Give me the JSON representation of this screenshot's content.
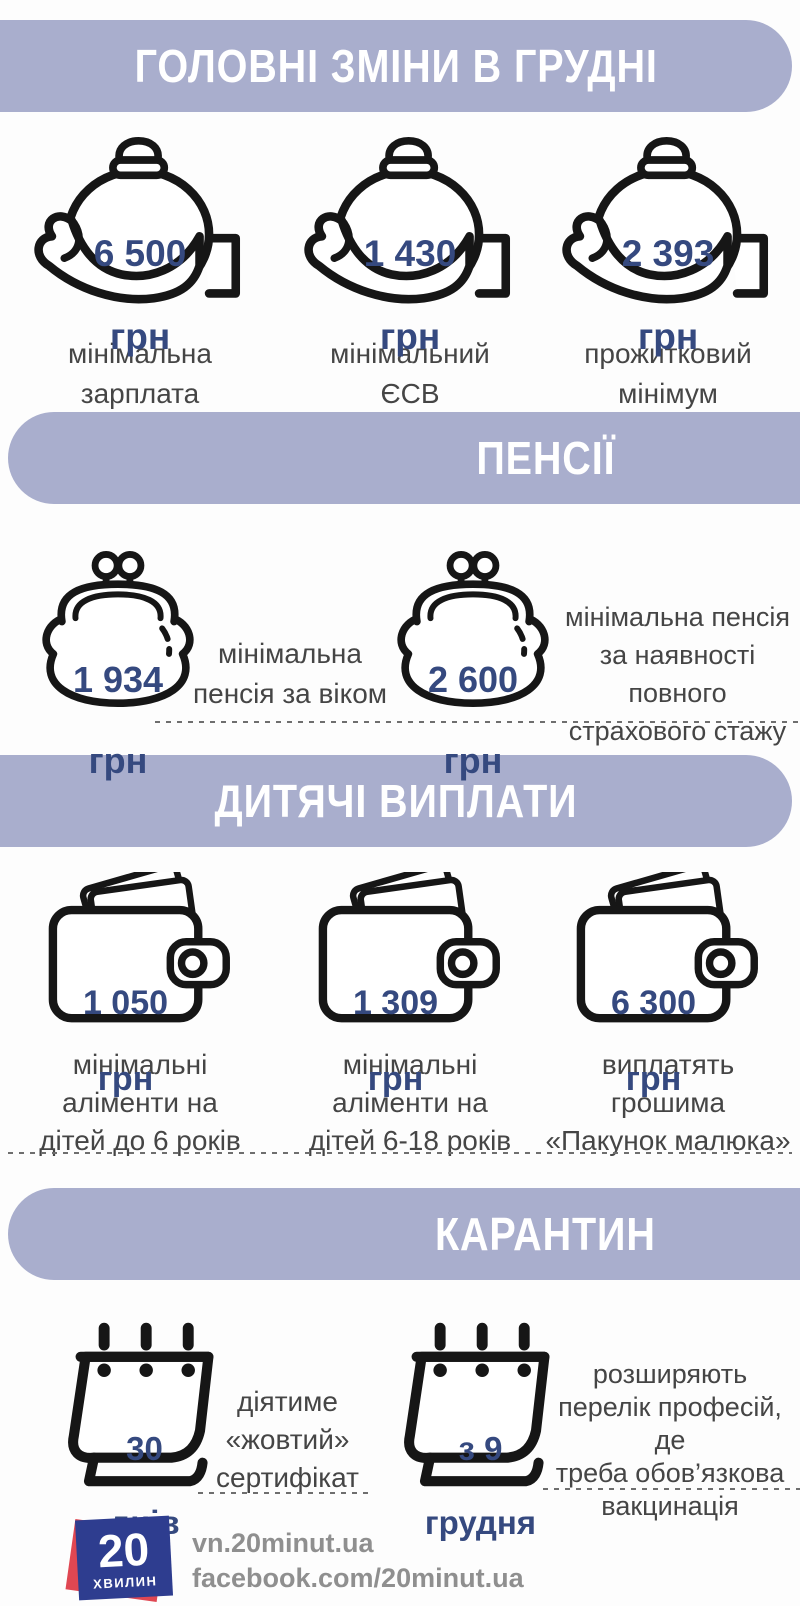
{
  "colors": {
    "banner_lavender": "#a9aecd",
    "value_blue": "#35497f",
    "label_gray": "#454545",
    "icon_black": "#161616",
    "footer_gray": "#8f8f8f",
    "logo_blue": "#2e3d8f",
    "logo_red": "#e04752"
  },
  "banners": {
    "main": "ГОЛОВНІ ЗМІНИ В ГРУДНІ",
    "pensions": "ПЕНСІЇ",
    "child": "ДИТЯЧІ ВИПЛАТИ",
    "quarantine": "КАРАНТИН"
  },
  "money_row": {
    "items": [
      {
        "value": "6 500",
        "unit": "грн",
        "label": "мінімальна\nзарплата"
      },
      {
        "value": "1 430",
        "unit": "грн",
        "label": "мінімальний\nЄСВ"
      },
      {
        "value": "2 393",
        "unit": "грн",
        "label": "прожитковий\nмінімум"
      }
    ]
  },
  "pensions_row": {
    "items": [
      {
        "value": "1 934",
        "unit": "грн",
        "label": "мінімальна\nпенсія за віком"
      },
      {
        "value": "2 600",
        "unit": "грн",
        "label": "мінімальна пенсія\nза наявності повного\nстрахового стажу"
      }
    ]
  },
  "child_row": {
    "items": [
      {
        "value": "1 050",
        "unit": "грн",
        "label": "мінімальні\nаліменти на\nдітей до 6 років"
      },
      {
        "value": "1 309",
        "unit": "грн",
        "label": "мінімальні\nаліменти на\nдітей 6-18 років"
      },
      {
        "value": "6 300",
        "unit": "грн",
        "label": "виплатять\nгрошима\n«Пакунок малюка»"
      }
    ]
  },
  "quarantine_row": {
    "items": [
      {
        "value": "30",
        "unit": "днів",
        "label": "діятиме\n«жовтий»\nсертифікат"
      },
      {
        "value": "з 9",
        "unit": "грудня",
        "label": "розширяють\nперелік професій, де\nтреба обов’язкова\nвакцинація"
      }
    ]
  },
  "footer": {
    "logo_number": "20",
    "logo_word": "ХВИЛИН",
    "site": "vn.20minut.ua",
    "facebook": "facebook.com/20minut.ua"
  }
}
